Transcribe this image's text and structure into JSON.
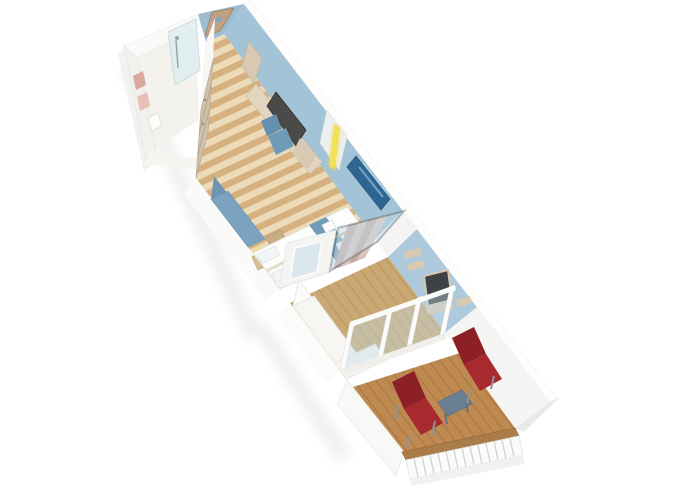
{
  "meta": {
    "kind": "3d-isometric-floorplan-render",
    "subject": "cruise-ship balcony cabin cutaway seen from above",
    "background": "#ffffff"
  },
  "scene": {
    "rooms": [
      {
        "name": "bathroom",
        "items": [
          "towel-rail",
          "toilet",
          "glass-shower"
        ]
      },
      {
        "name": "entry-corridor",
        "items": [
          "entrance-door",
          "door-plaque",
          "wardrobe",
          "desk-tv-unit",
          "desk-chair",
          "mood-light"
        ]
      },
      {
        "name": "bedroom",
        "items": [
          "sofa-bench",
          "side-stool",
          "nightstand-lamp",
          "twin-bed",
          "twin-bed",
          "bed-runner",
          "folded-towel",
          "wall-art",
          "partition-glass-door",
          "curtain"
        ]
      },
      {
        "name": "sitting-room",
        "items": [
          "white-l-sofa",
          "wall-shelves",
          "wall-mirror",
          "balcony-glass-doors"
        ]
      },
      {
        "name": "balcony",
        "items": [
          "wood-deck",
          "deck-chair",
          "deck-chair",
          "balcony-table",
          "railing"
        ]
      }
    ]
  },
  "palette": {
    "wall_blue": "#a3c3d6",
    "wall_blue_light": "#accadb",
    "end_wall": "#9cbcd1",
    "partition": "#f4f4f2",
    "white_wall": "#f5f5f3",
    "door": "#c0a183",
    "plaque": "#7fa9c2",
    "floor_base": "#ecdbb9",
    "living_floor": "#c9a873",
    "deck": "#bf8a52",
    "rail_cap": "#a97c48",
    "wood_wardrobe": "#cfc1ab",
    "shelf": "#d9c9b2",
    "desk": "#e3d6c0",
    "tv": "#4a4a48",
    "mirror": "#3f4245",
    "chair_blue": "#6f9ab8",
    "chair_blue_dark": "#6390ae",
    "sofa_blue": "#7ba3bf",
    "sofa_blue_dark": "#6d95b2",
    "bed": "#fdfdfc",
    "runner": "#6f9cb8",
    "towel": "#dba8a0",
    "towel2": "#e8c0b8",
    "art": "#2f6591",
    "curtain1": "#c7a9a2",
    "curtain2": "#dbc6bb",
    "red_chair": "#a8292e",
    "red_chair_dark": "#8c2026",
    "chair_frame": "#8b959c",
    "table": "#6b7f92",
    "lamp": "#f2df5a",
    "glass": "#c4dbe8",
    "shower_glass": "#dceef0",
    "stool": "#c9ae83",
    "nightstand": "#d8bf95"
  }
}
